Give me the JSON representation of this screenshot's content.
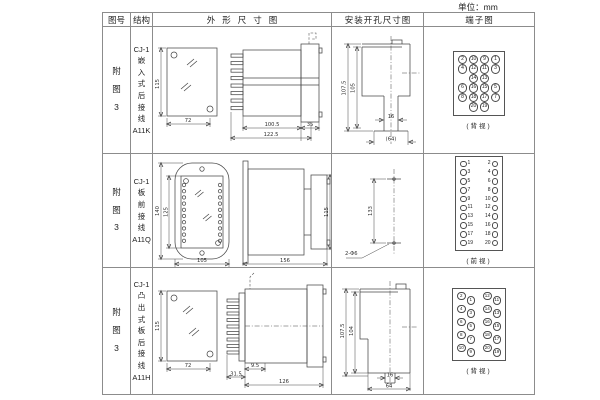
{
  "unit_note": "单位：mm",
  "header": {
    "figure": "图号",
    "structure": "结构",
    "outline": "外形尺寸图",
    "mounting": "安装开孔尺寸图",
    "terminal": "端子图"
  },
  "rows": [
    {
      "figure": "附\n图\n3",
      "structure": "CJ-1\n嵌\n入\n式\n后\n接\n线\nA11K",
      "outline_dims": {
        "front_height": "115",
        "front_width": "72",
        "body_depth": "100.5",
        "overall_depth": "122.5",
        "bezel_depth": "35"
      },
      "mounting_dims": {
        "outer_height": "107.5",
        "inner_height": "105",
        "slot_width": "16",
        "bottom_width": "(64)"
      },
      "terminal": {
        "type": "grid",
        "view_label": "(背视)",
        "rows": [
          [
            "2",
            "10",
            "9",
            "1"
          ],
          [
            "4",
            "12",
            "11",
            "3"
          ],
          [
            "",
            "14",
            "13",
            ""
          ],
          [
            "6",
            "16",
            "15",
            "5"
          ],
          [
            "8",
            "18",
            "17",
            "7"
          ],
          [
            "",
            "20",
            "19",
            ""
          ]
        ]
      }
    },
    {
      "figure": "附\n图\n3",
      "structure": "CJ-1\n板\n前\n接\n线\nA11Q",
      "outline_dims": {
        "front_height": "140",
        "inner_height": "125",
        "front_width": "105",
        "body_length": "156",
        "body_height": "115"
      },
      "mounting_dims": {
        "hole_span": "133",
        "holes": "2-Φ6"
      },
      "terminal": {
        "type": "columns",
        "view_label": "(前视)",
        "left": [
          "1",
          "3",
          "5",
          "7",
          "9",
          "11",
          "13",
          "15",
          "17",
          "19"
        ],
        "right": [
          "2",
          "4",
          "6",
          "8",
          "10",
          "12",
          "14",
          "16",
          "18",
          "20"
        ]
      }
    },
    {
      "figure": "附\n图\n3",
      "structure": "CJ-1\n凸\n出\n式\n板\n后\n接\n线\nA11H",
      "outline_dims": {
        "front_height": "115",
        "front_width": "72",
        "stud_length": "31.5",
        "front_depth": "9.5",
        "overall_length": "126"
      },
      "mounting_dims": {
        "outer_height": "107.5",
        "inner_height": "104",
        "slot_width": "16",
        "bottom_width": "64"
      },
      "terminal": {
        "type": "staggered",
        "view_label": "(背视)",
        "left": [
          [
            "2",
            "1"
          ],
          [
            "4",
            "3"
          ],
          [
            "6",
            "5"
          ],
          [
            "8",
            "7"
          ],
          [
            "10",
            "9"
          ]
        ],
        "right": [
          [
            "12",
            "11"
          ],
          [
            "14",
            "13"
          ],
          [
            "16",
            "15"
          ],
          [
            "18",
            "17"
          ],
          [
            "20",
            "19"
          ]
        ]
      }
    }
  ]
}
